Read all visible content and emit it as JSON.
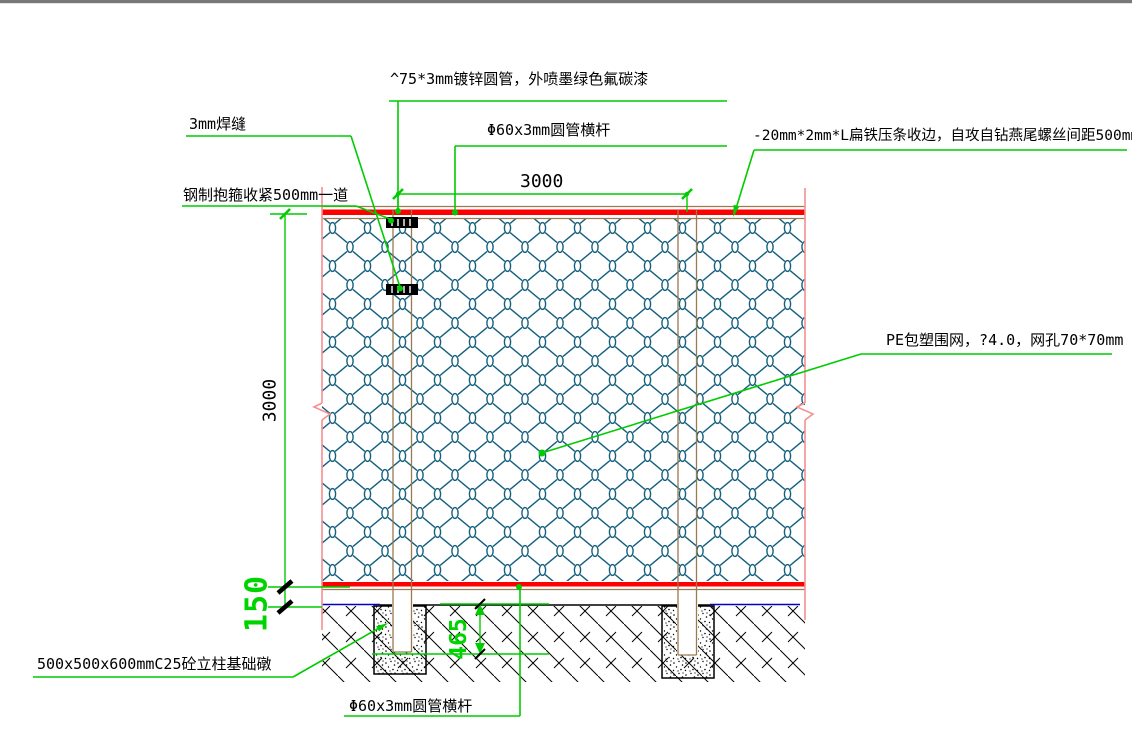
{
  "drawing": {
    "title_context": "fence-construction-detail",
    "labels": {
      "top_pipe": "^75*3mm镀锌圆管，外喷墨绿色氟碳漆",
      "top_rail": "Φ60x3mm圆管横杆",
      "weld": "3mm焊缝",
      "clamp": "钢制抱箍收紧500mm一道",
      "flat_iron": "-20mm*2mm*L扁铁压条收边，自攻自钻燕尾螺丝间距500mm",
      "mesh": "PE包塑围网，?4.0，网孔70*70mm",
      "foundation": "500x500x600mmC25砼立柱基础礅",
      "bottom_rail": "Φ60x3mm圆管横杆"
    },
    "dimensions": {
      "span_mm": "3000",
      "height_mm": "3000",
      "ground_gap_mm": "150",
      "embed_depth_mm": "465"
    },
    "colors": {
      "leader_green": "#00cc00",
      "dim_text_green": "#00d400",
      "rail_red": "#ff0000",
      "frame_brown": "#9a7a50",
      "mesh_teal": "#15607f",
      "edge_pink": "#f49090",
      "ground_blue": "#0000cc",
      "border_gray": "#787878"
    }
  }
}
